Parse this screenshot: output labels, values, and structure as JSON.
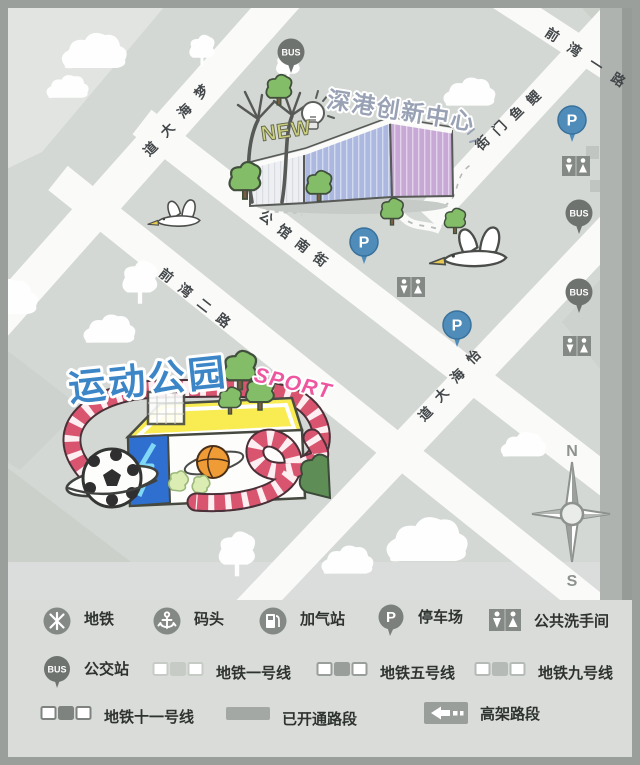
{
  "map": {
    "innovation_center": {
      "title": "深港创新中心",
      "badge": "NEW"
    },
    "sports_park": {
      "title": "运动公园",
      "subtitle": "SPORT"
    },
    "streets": {
      "menghai": "梦海大道",
      "qianwan2": "前湾二路",
      "gongguan": "公馆南街",
      "liyumen": "鲤鱼门街",
      "qianwan1": "前湾一路",
      "yihai": "怡海大道"
    },
    "poi": {
      "bus": "BUS",
      "parking": "P"
    },
    "compass": {
      "north": "N",
      "south": "S"
    }
  },
  "legend": {
    "items": [
      {
        "icon": "metro-icon",
        "label": "地铁"
      },
      {
        "icon": "wharf-icon",
        "label": "码头"
      },
      {
        "icon": "gas-station-icon",
        "label": "加气站"
      },
      {
        "icon": "parking-icon",
        "label": "停车场"
      },
      {
        "icon": "restroom-icon",
        "label": "公共洗手间"
      },
      {
        "icon": "bus-stop-icon",
        "label": "公交站"
      },
      {
        "icon": "metro-line-1-icon",
        "label": "地铁一号线"
      },
      {
        "icon": "metro-line-5-icon",
        "label": "地铁五号线"
      },
      {
        "icon": "metro-line-9-icon",
        "label": "地铁九号线"
      },
      {
        "icon": "metro-line-11-icon",
        "label": "地铁十一号线"
      },
      {
        "icon": "opened-road-icon",
        "label": "已开通路段"
      },
      {
        "icon": "elevated-road-icon",
        "label": "高架路段"
      }
    ]
  },
  "colors": {
    "map_background": "#d4d8d4",
    "road": "#fafbf9",
    "park_title": "#3c86c8",
    "sport_accent": "#ee57a0",
    "track": "#d9556f",
    "innovation_title": "#99a2b5",
    "parking_pin": "#4f8cba",
    "bus_pin": "#6e7370"
  }
}
